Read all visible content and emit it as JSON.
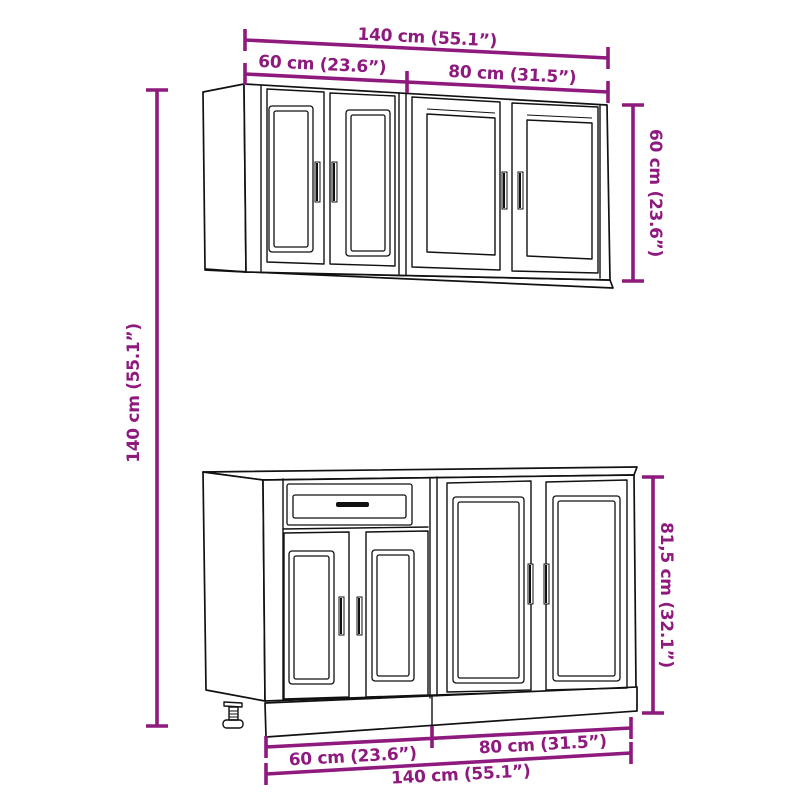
{
  "diagram": {
    "subject": "kitchen-cabinet-set-dimension-diagram",
    "pieces": [
      "wall-cabinet-60cm",
      "wall-cabinet-80cm",
      "base-cabinet-60cm-with-drawer",
      "base-cabinet-80cm"
    ],
    "colors": {
      "dimension_accent": "#8E1A7D",
      "line_art": "#111111",
      "background": "#FFFFFF"
    },
    "dimensions": {
      "top_total_width": "140 cm (55.1”)",
      "top_left_width": "60 cm (23.6”)",
      "top_right_width": "80 cm (31.5”)",
      "wall_cabinet_height": "60 cm (23.6”)",
      "total_height": "140 cm (55.1”)",
      "base_cabinet_height": "81,5 cm (32.1”)",
      "bottom_left_width": "60 cm (23.6”)",
      "bottom_right_width": "80 cm (31.5”)",
      "bottom_total_width": "140 cm (55.1”)"
    }
  }
}
